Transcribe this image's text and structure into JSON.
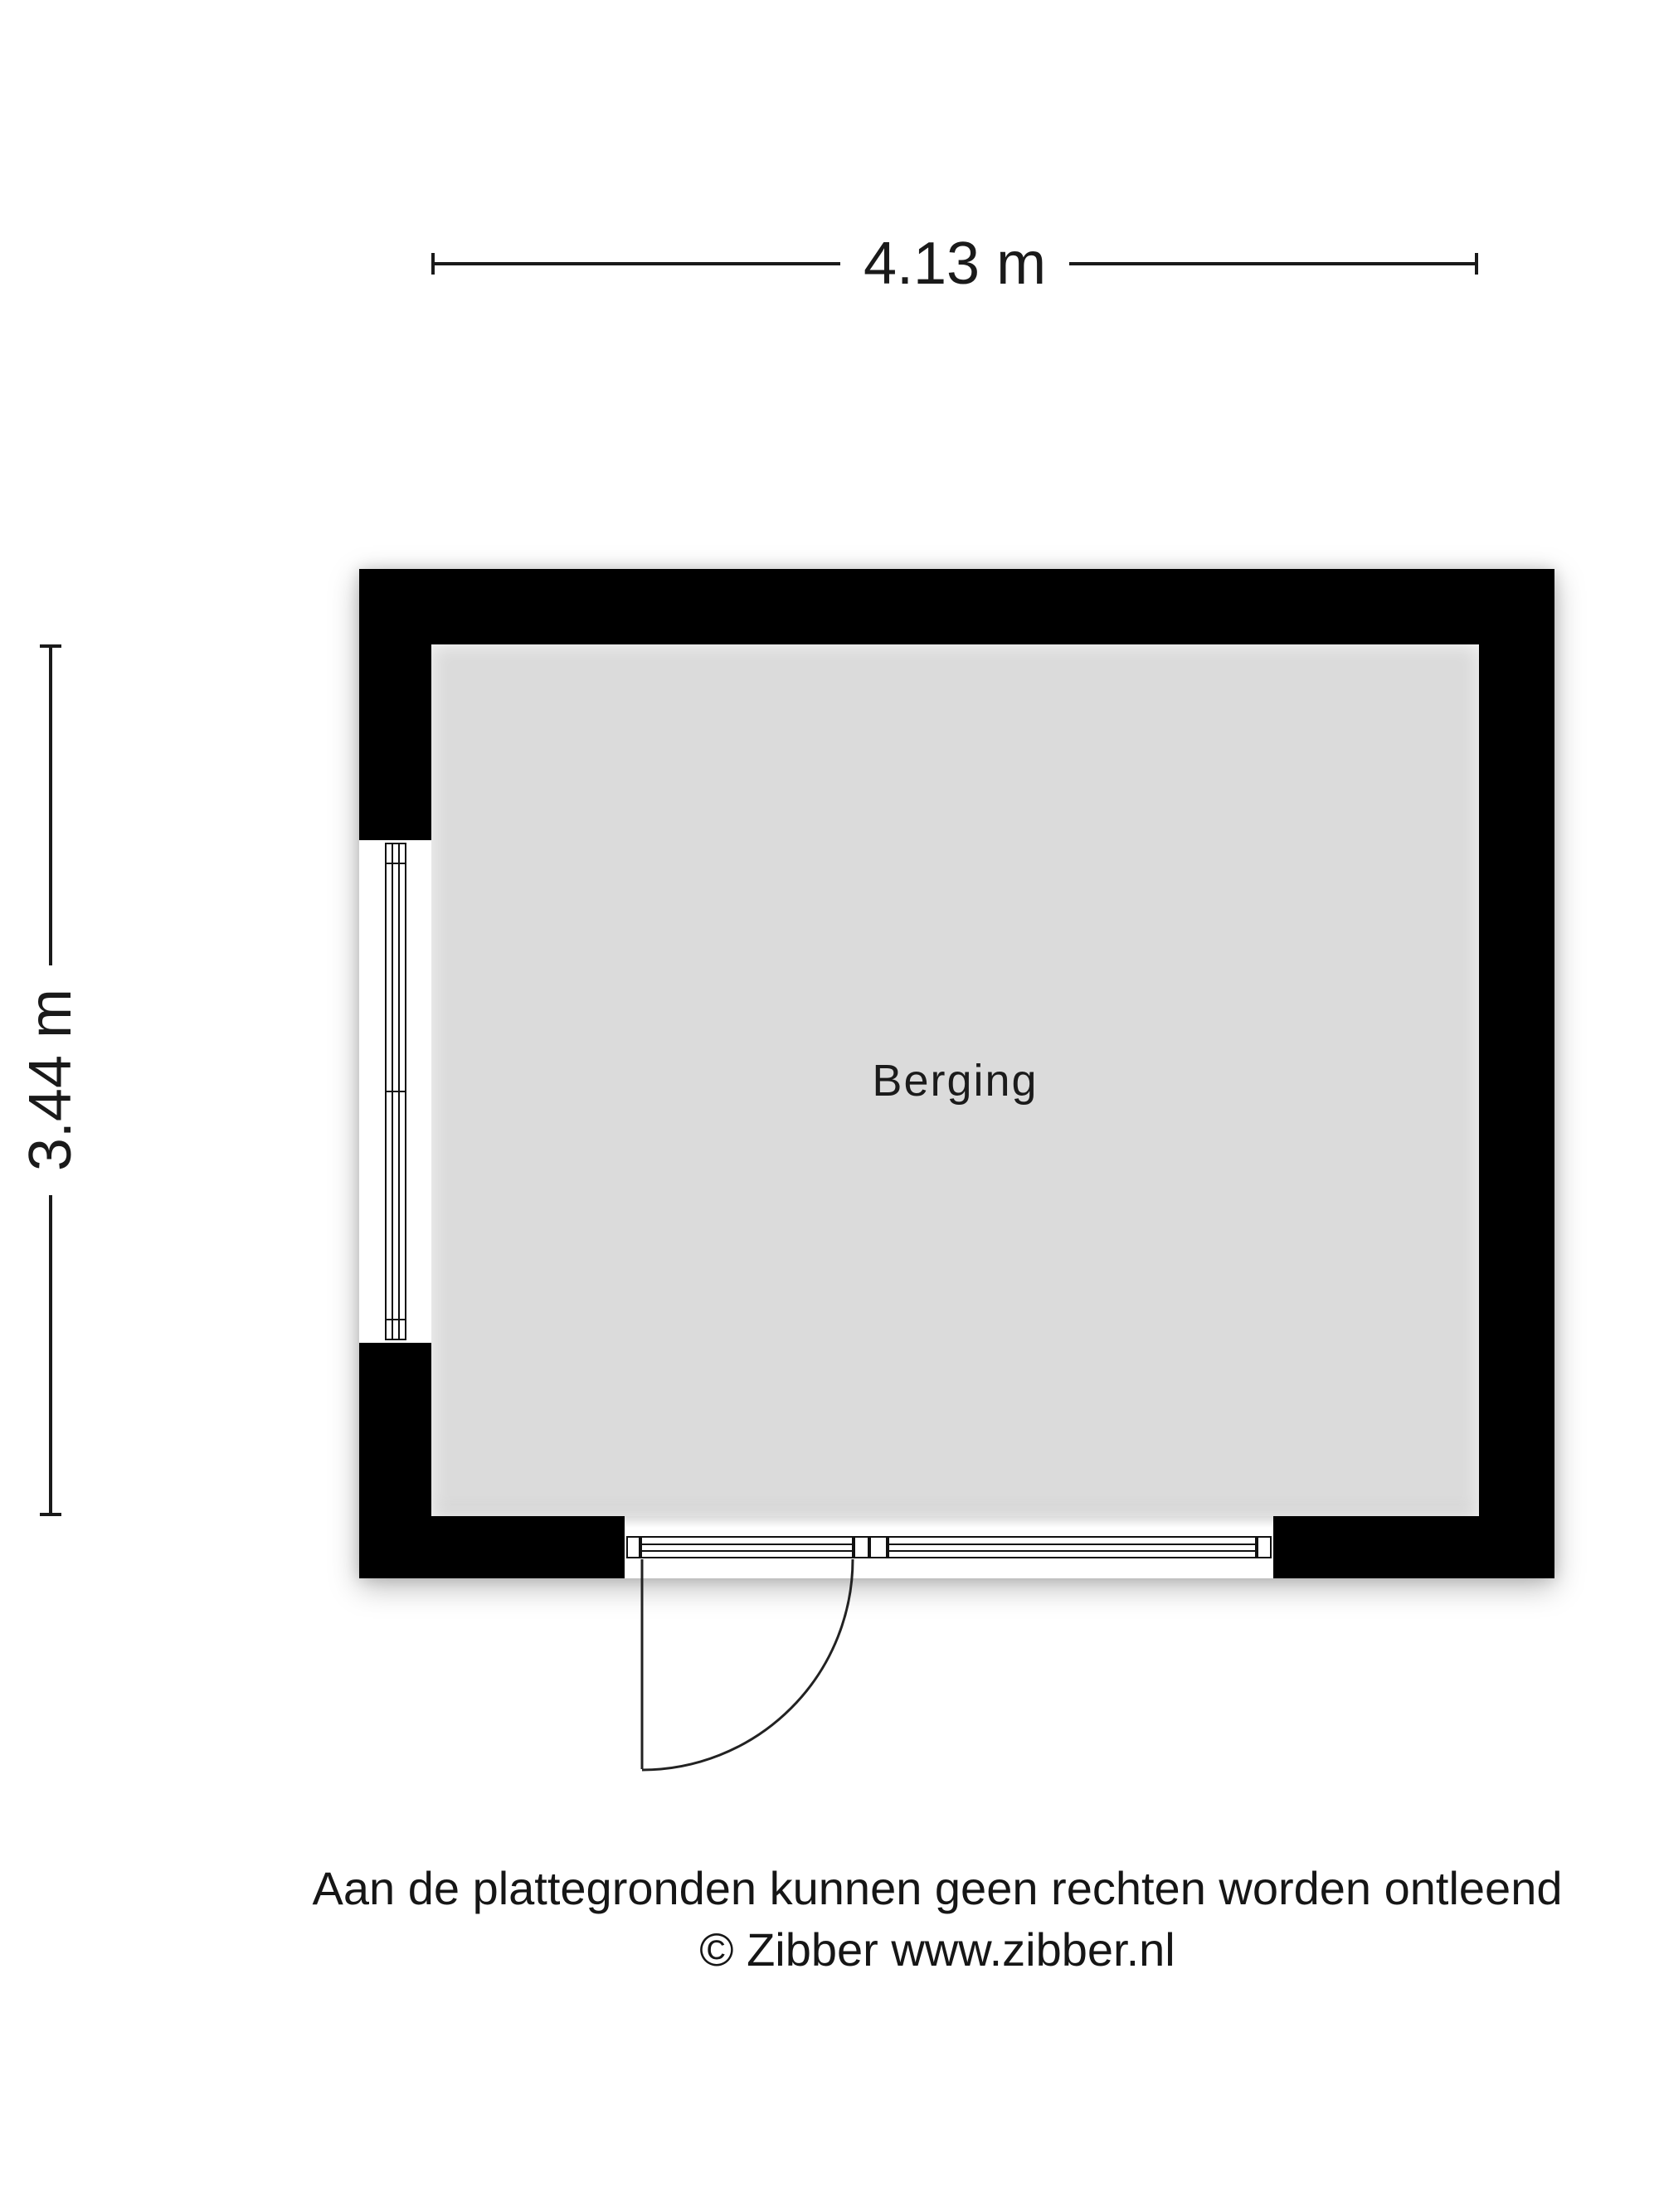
{
  "room": {
    "name": "Berging"
  },
  "dimensions": {
    "width": "4.13 m",
    "height": "3.44 m"
  },
  "footer": {
    "disclaimer": "Aan de plattegronden kunnen geen rechten worden ontleend",
    "copyright": "© Zibber www.zibber.nl"
  },
  "colors": {
    "wall": "#000000",
    "floor": "#dbdbdb",
    "line": "#1a1a1a",
    "background": "#ffffff"
  }
}
